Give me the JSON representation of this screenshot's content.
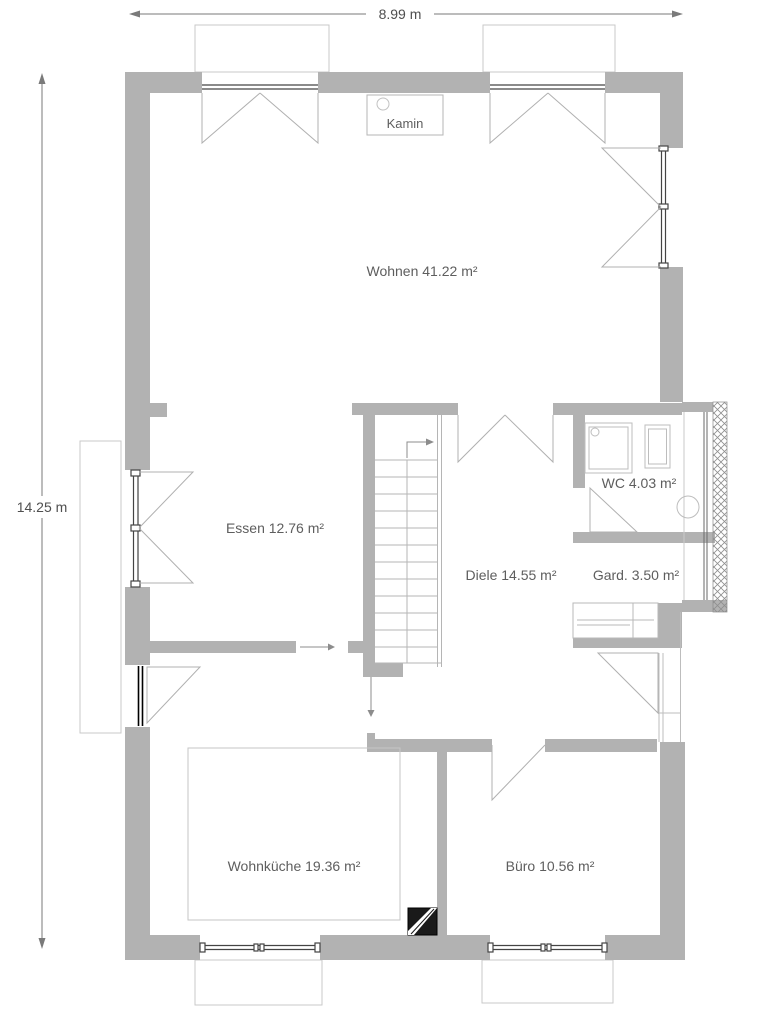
{
  "plan": {
    "type": "floor-plan",
    "dimensions": {
      "width_label": "8.99 m",
      "height_label": "14.25 m"
    },
    "rooms": [
      {
        "id": "wohnen",
        "label": "Wohnen 41.22 m²"
      },
      {
        "id": "essen",
        "label": "Essen 12.76 m²"
      },
      {
        "id": "diele",
        "label": "Diele 14.55 m²"
      },
      {
        "id": "wc",
        "label": "WC 4.03 m²"
      },
      {
        "id": "garderobe",
        "label": "Gard. 3.50 m²"
      },
      {
        "id": "wohnkueche",
        "label": "Wohnküche 19.36 m²"
      },
      {
        "id": "buero",
        "label": "Büro 10.56 m²"
      }
    ],
    "features": {
      "kamin_label": "Kamin"
    },
    "colors": {
      "wall": "#b2b2b2",
      "swing_line": "#b0b0b0",
      "furniture_line": "#bdbdbd",
      "window_line": "#444444",
      "entry_door_line": "#000000",
      "text": "#5e5e5e",
      "dimension_line": "#777777",
      "chimney_fill": "#1a1a1a"
    }
  }
}
